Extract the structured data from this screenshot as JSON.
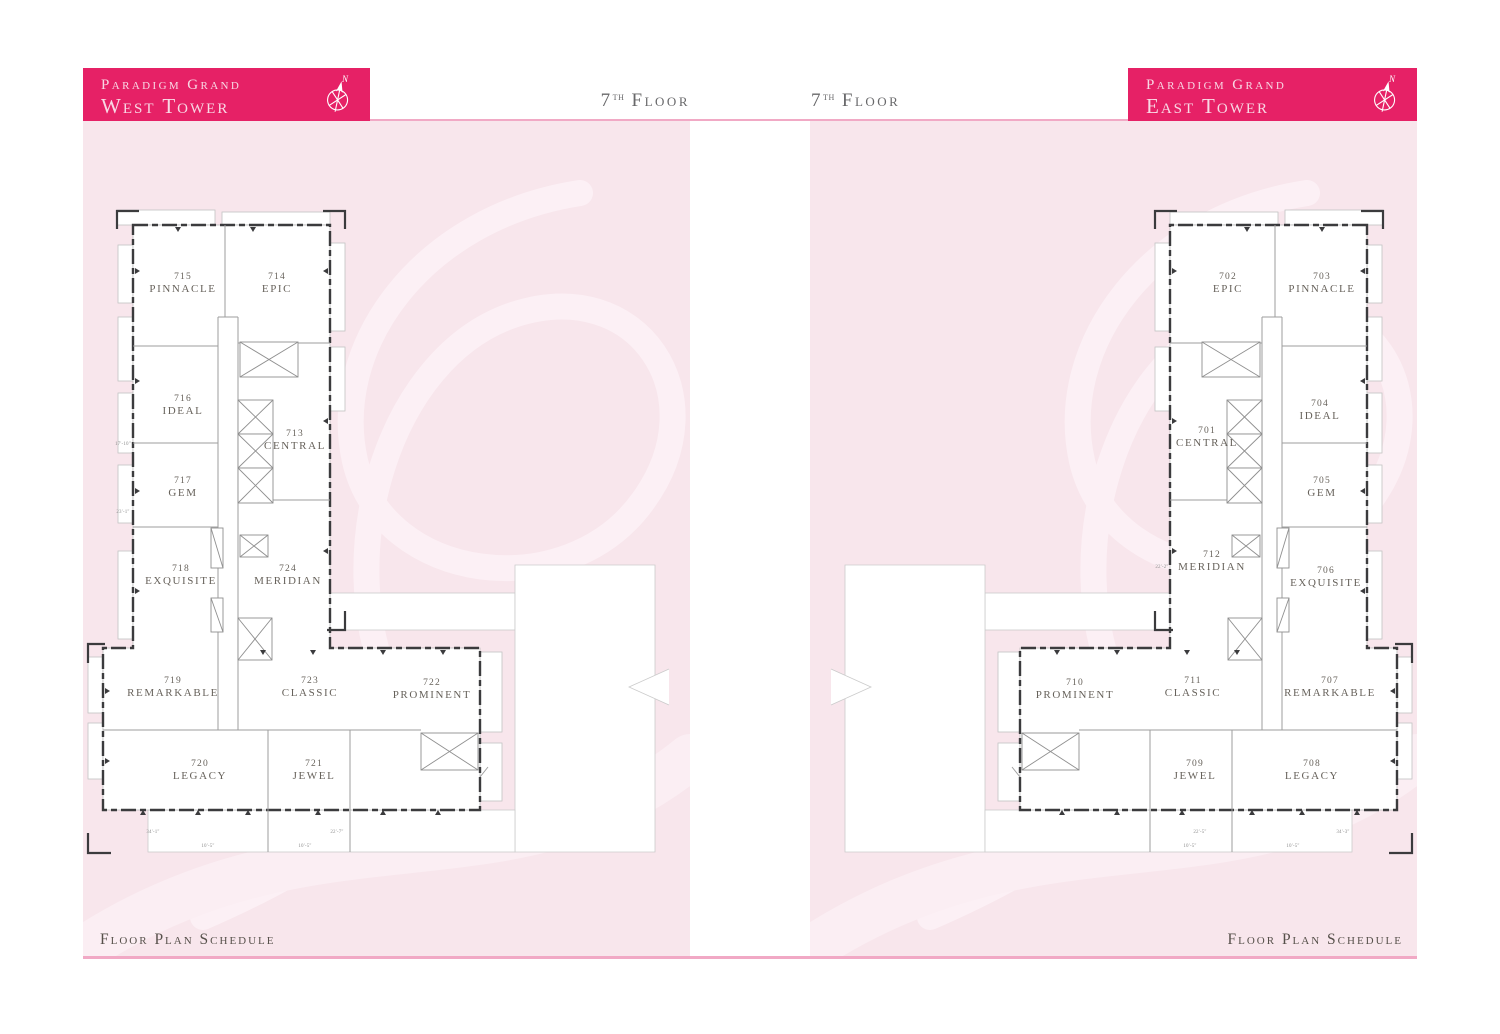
{
  "banners": {
    "west": {
      "project": "Paradigm Grand",
      "tower": "West Tower",
      "compass": "N"
    },
    "east": {
      "project": "Paradigm Grand",
      "tower": "East Tower",
      "compass": "N"
    }
  },
  "floor_labels": {
    "west": {
      "num": "7",
      "suffix": "th",
      "word": "Floor"
    },
    "east": {
      "num": "7",
      "suffix": "th",
      "word": "Floor"
    }
  },
  "footers": {
    "west": "Floor Plan Schedule",
    "east": "Floor Plan Schedule"
  },
  "palette": {
    "banner_pink": "#E62166",
    "panel_pink": "#F8E6EC",
    "watermark_pink": "#FCF0F5",
    "rule_pink": "#F1A9C5",
    "wall_dark": "#3B3B3D",
    "partition_gray": "#9E9E9E",
    "balcony_gray": "#C2C2C2",
    "unit_text": "#67625B",
    "floor_heading": "#68686A",
    "footer_text": "#56504A"
  },
  "plans": {
    "west": {
      "units": [
        {
          "num": "715",
          "name": "PINNACLE",
          "x": 100,
          "y": 158
        },
        {
          "num": "714",
          "name": "EPIC",
          "x": 194,
          "y": 158
        },
        {
          "num": "716",
          "name": "IDEAL",
          "x": 100,
          "y": 280
        },
        {
          "num": "713",
          "name": "CENTRAL",
          "x": 212,
          "y": 315
        },
        {
          "num": "717",
          "name": "GEM",
          "x": 100,
          "y": 362
        },
        {
          "num": "718",
          "name": "EXQUISITE",
          "x": 98,
          "y": 450
        },
        {
          "num": "724",
          "name": "MERIDIAN",
          "x": 205,
          "y": 450
        },
        {
          "num": "719",
          "name": "REMARKABLE",
          "x": 90,
          "y": 562
        },
        {
          "num": "723",
          "name": "CLASSIC",
          "x": 227,
          "y": 562
        },
        {
          "num": "722",
          "name": "PROMINENT",
          "x": 349,
          "y": 564
        },
        {
          "num": "720",
          "name": "LEGACY",
          "x": 117,
          "y": 645
        },
        {
          "num": "721",
          "name": "JEWEL",
          "x": 231,
          "y": 645
        }
      ],
      "dims": [
        {
          "t": "34'-1\"",
          "x": 70,
          "y": 712
        },
        {
          "t": "10'-5\"",
          "x": 125,
          "y": 726
        },
        {
          "t": "10'-5\"",
          "x": 222,
          "y": 726
        },
        {
          "t": "22'-7\"",
          "x": 254,
          "y": 712
        },
        {
          "t": "23'-1\"",
          "x": 40,
          "y": 392
        },
        {
          "t": "17'-10\"",
          "x": 40,
          "y": 324
        }
      ]
    },
    "east": {
      "units": [
        {
          "num": "702",
          "name": "EPIC",
          "x": 418,
          "y": 158
        },
        {
          "num": "703",
          "name": "PINNACLE",
          "x": 512,
          "y": 158
        },
        {
          "num": "701",
          "name": "CENTRAL",
          "x": 397,
          "y": 312
        },
        {
          "num": "704",
          "name": "IDEAL",
          "x": 510,
          "y": 285
        },
        {
          "num": "705",
          "name": "GEM",
          "x": 512,
          "y": 362
        },
        {
          "num": "712",
          "name": "MERIDIAN",
          "x": 402,
          "y": 436
        },
        {
          "num": "706",
          "name": "EXQUISITE",
          "x": 516,
          "y": 452
        },
        {
          "num": "710",
          "name": "PROMINENT",
          "x": 265,
          "y": 564
        },
        {
          "num": "711",
          "name": "CLASSIC",
          "x": 383,
          "y": 562
        },
        {
          "num": "707",
          "name": "REMARKABLE",
          "x": 520,
          "y": 562
        },
        {
          "num": "709",
          "name": "JEWEL",
          "x": 385,
          "y": 645
        },
        {
          "num": "708",
          "name": "LEGACY",
          "x": 502,
          "y": 645
        }
      ],
      "dims": [
        {
          "t": "34'-3\"",
          "x": 533,
          "y": 712
        },
        {
          "t": "10'-5\"",
          "x": 483,
          "y": 726
        },
        {
          "t": "10'-5\"",
          "x": 380,
          "y": 726
        },
        {
          "t": "22'-5\"",
          "x": 390,
          "y": 712
        },
        {
          "t": "22'-2\"",
          "x": 352,
          "y": 447
        }
      ]
    }
  }
}
